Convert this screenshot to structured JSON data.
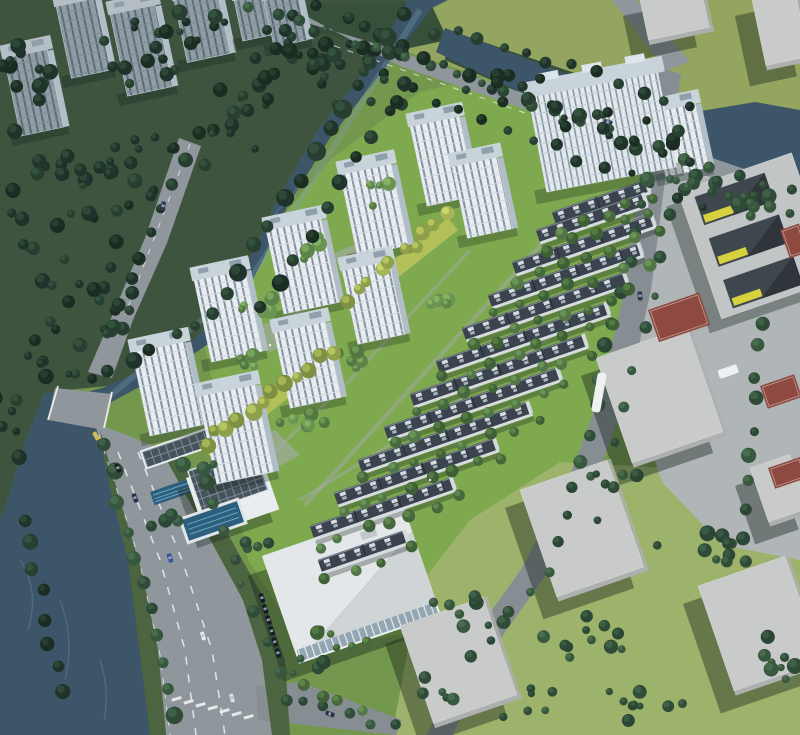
{
  "meta": {
    "title": "Aerial rendering of a riverside residential development with high-rise towers, townhouse rows, canal, arterial road and surrounding context blocks"
  },
  "colors": {
    "siteGreen": "#7ea94f",
    "lawnNE": "#93a55e",
    "lawnSE": "#9db26b",
    "plaza": "#b0b5b8",
    "darkZone": "#3e543f",
    "darkBand": "#36503a",
    "verge": "#4c6440",
    "waterDark": "#3c5568",
    "waterMid": "#46617595",
    "waterLight": "#7da0b2",
    "road": "#8f979c",
    "roadMinor": "#868e93",
    "laneMark": "#eef1f2",
    "pathGray": "#a3aaa6",
    "towerFace": "#e9edef",
    "towerWin": "#64788a",
    "towerRoof": "#c8d3da",
    "towerSide": "#b2bec7",
    "ctxFace": "#909da5",
    "ctxWin": "#53636d",
    "ctxRoof": "#b4bec4",
    "slabFace": "#e3e8eb",
    "slabWin": "#6d8294",
    "rowRoof": "#3a434e",
    "rowPanel": "#dde4e9",
    "rowFace": "#d6dbdf",
    "rowEnd": "#d3dade",
    "boxTop": "#c9cbca",
    "boxSide": "#aeb0af",
    "schoolTop": "#c2c5c6",
    "schoolCourt": "#3f474e",
    "schoolYellow": "#d6d23f",
    "courtRed": "#8e4a40",
    "commWall": "#eceff0",
    "commRoofA": "#e4e7e9",
    "commRoofB": "#cfd4d6",
    "commGlass": "#93a6b1",
    "poolDark": "#2c5e7d",
    "poolLight": "#7fb6cd",
    "yellowBand": "#b9c25a",
    "shadow": "#13211a",
    "carDark": "#151c27",
    "busWhite": "#eef1f2"
  },
  "scene": {
    "towers": [
      [
        132,
        352,
        54,
        86
      ],
      [
        198,
        396,
        58,
        90
      ],
      [
        194,
        280,
        52,
        84
      ],
      [
        266,
        230,
        56,
        86
      ],
      [
        274,
        332,
        52,
        78
      ],
      [
        340,
        174,
        52,
        84
      ],
      [
        342,
        270,
        48,
        76
      ],
      [
        410,
        126,
        50,
        82
      ],
      [
        452,
        166,
        46,
        74
      ],
      [
        652,
        112,
        44,
        66
      ]
    ],
    "slab": {
      "x": 528,
      "y": 96,
      "w": 132,
      "h": 98
    },
    "context_towers": [
      [
        4,
        58,
        44,
        80
      ],
      [
        56,
        6,
        40,
        74
      ],
      [
        110,
        14,
        46,
        84
      ],
      [
        174,
        0,
        44,
        64
      ],
      [
        234,
        0,
        30,
        42
      ],
      [
        264,
        0,
        34,
        48
      ]
    ],
    "townhouse_rows": [
      [
        552,
        212,
        100
      ],
      [
        536,
        230,
        114
      ],
      [
        512,
        262,
        148
      ],
      [
        488,
        295,
        160
      ],
      [
        462,
        328,
        172
      ],
      [
        436,
        361,
        180
      ],
      [
        410,
        394,
        184
      ],
      [
        384,
        427,
        184
      ],
      [
        358,
        460,
        180
      ],
      [
        334,
        493,
        170
      ],
      [
        310,
        526,
        150
      ],
      [
        318,
        560,
        92
      ]
    ],
    "context_boxes": [
      [
        596,
        358,
        100,
        116,
        -19
      ],
      [
        520,
        490,
        96,
        118,
        -19
      ],
      [
        400,
        626,
        92,
        108,
        -19
      ],
      [
        698,
        586,
        96,
        116,
        -19
      ],
      [
        750,
        468,
        46,
        62,
        -19
      ],
      [
        640,
        0,
        66,
        46,
        -12
      ],
      [
        752,
        0,
        48,
        72,
        -12
      ]
    ],
    "red_courts": [
      [
        648,
        310,
        54,
        34
      ],
      [
        760,
        386,
        36,
        24
      ],
      [
        768,
        468,
        34,
        22
      ],
      [
        780,
        230,
        20,
        30
      ]
    ],
    "tree_clusters": [
      [
        60,
        210,
        75,
        55,
        24,
        "dark"
      ],
      [
        150,
        178,
        60,
        42,
        16,
        "dark"
      ],
      [
        238,
        118,
        52,
        40,
        14,
        "dark"
      ],
      [
        88,
        298,
        62,
        42,
        16,
        "dark"
      ],
      [
        24,
        95,
        40,
        52,
        12,
        "dark"
      ],
      [
        130,
        52,
        55,
        32,
        12,
        "dark"
      ],
      [
        210,
        28,
        48,
        22,
        9,
        "dark"
      ],
      [
        282,
        66,
        45,
        28,
        10,
        "dark"
      ],
      [
        55,
        352,
        42,
        26,
        9,
        "dark"
      ],
      [
        6,
        428,
        26,
        36,
        7,
        "dark"
      ],
      [
        362,
        74,
        72,
        42,
        20,
        "dark"
      ],
      [
        325,
        26,
        45,
        22,
        9,
        "dark"
      ],
      [
        688,
        182,
        34,
        15,
        7,
        "mid"
      ],
      [
        748,
        204,
        28,
        13,
        6,
        "mid"
      ],
      [
        505,
        88,
        42,
        18,
        8,
        "dark"
      ],
      [
        585,
        112,
        42,
        18,
        8,
        "dark"
      ],
      [
        645,
        135,
        36,
        16,
        7,
        "dark"
      ],
      [
        575,
        645,
        55,
        30,
        11,
        "mid"
      ],
      [
        690,
        552,
        45,
        26,
        9,
        "mid"
      ],
      [
        655,
        700,
        52,
        26,
        9,
        "mid"
      ],
      [
        768,
        648,
        34,
        38,
        8,
        "mid"
      ],
      [
        525,
        702,
        34,
        20,
        6,
        "mid"
      ],
      [
        468,
        612,
        40,
        24,
        8,
        "mid"
      ],
      [
        608,
        478,
        34,
        18,
        6,
        "mid"
      ],
      [
        432,
        692,
        28,
        18,
        5,
        "mid"
      ],
      [
        252,
        300,
        26,
        18,
        6,
        "lightB"
      ],
      [
        318,
        248,
        24,
        16,
        5,
        "lightB"
      ],
      [
        385,
        195,
        24,
        16,
        5,
        "lightB"
      ],
      [
        300,
        420,
        26,
        16,
        6,
        "lightB"
      ],
      [
        360,
        355,
        24,
        14,
        5,
        "lightB"
      ],
      [
        430,
        300,
        22,
        14,
        5,
        "lightB"
      ],
      [
        245,
        368,
        20,
        14,
        4,
        "lightB"
      ],
      [
        200,
        472,
        22,
        14,
        5,
        "mid"
      ],
      [
        165,
        520,
        20,
        12,
        4,
        "mid"
      ],
      [
        252,
        545,
        18,
        12,
        4,
        "mid"
      ],
      [
        338,
        640,
        30,
        16,
        6,
        "bright"
      ],
      [
        300,
        665,
        24,
        14,
        5,
        "mid"
      ]
    ],
    "tree_lines": [
      [
        250,
        6,
        788,
        192,
        22,
        "mid",
        5
      ],
      [
        268,
        34,
        700,
        205,
        19,
        "dark",
        5
      ],
      [
        402,
        12,
        225,
        295,
        13,
        "dark",
        8
      ],
      [
        215,
        310,
        90,
        382,
        7,
        "dark",
        7
      ],
      [
        436,
        34,
        262,
        310,
        12,
        "dark",
        7
      ],
      [
        455,
        30,
        690,
        105,
        11,
        "dark",
        6
      ],
      [
        445,
        62,
        688,
        162,
        10,
        "dark",
        6
      ],
      [
        106,
        448,
        178,
        718,
        11,
        "mid",
        7
      ],
      [
        210,
        500,
        288,
        700,
        8,
        "mid",
        5
      ],
      [
        25,
        520,
        60,
        690,
        8,
        "dark",
        8
      ],
      [
        650,
        180,
        560,
        545,
        14,
        "mid",
        6
      ],
      [
        548,
        570,
        470,
        660,
        5,
        "mid",
        6
      ],
      [
        680,
        180,
        600,
        520,
        10,
        "mid",
        5
      ],
      [
        760,
        320,
        742,
        565,
        10,
        "mid",
        6
      ],
      [
        690,
        190,
        790,
        215,
        6,
        "mid",
        5
      ],
      [
        300,
        700,
        395,
        728,
        5,
        "mid",
        5
      ],
      [
        205,
        442,
        330,
        350,
        12,
        "yel",
        7
      ],
      [
        345,
        298,
        448,
        216,
        10,
        "yel",
        6
      ],
      [
        185,
        160,
        110,
        330,
        8,
        "dark",
        6
      ],
      [
        300,
        688,
        360,
        712,
        4,
        "bright",
        6
      ]
    ],
    "cars": [
      [
        135,
        498,
        70,
        "#23304f"
      ],
      [
        170,
        558,
        72,
        "#2f57a0"
      ],
      [
        203,
        636,
        74,
        "#e9ecee"
      ],
      [
        232,
        698,
        76,
        "#dde0e2"
      ],
      [
        118,
        468,
        68,
        "#171e29"
      ],
      [
        96,
        436,
        62,
        "#d6bf3b"
      ],
      [
        163,
        206,
        104,
        "#2b3a55"
      ],
      [
        608,
        122,
        17,
        "#32415c"
      ],
      [
        640,
        296,
        86,
        "#2e3a4e"
      ],
      [
        330,
        714,
        20,
        "#263249"
      ]
    ],
    "parked_cars": [
      {
        "x": 262,
        "y": 598,
        "sx": 3.2,
        "sy": 11,
        "n": 6,
        "a": 72
      }
    ],
    "bus": {
      "x": 598,
      "y": 372,
      "a": 10
    },
    "crosswalk": {
      "x1": 181,
      "y1": 696,
      "x2": 253,
      "y2": 714,
      "n": 7,
      "a": 74
    },
    "people": [
      [
        255,
        330
      ],
      [
        270,
        345
      ],
      [
        320,
        300
      ],
      [
        230,
        440
      ],
      [
        430,
        480
      ],
      [
        470,
        330
      ]
    ],
    "counts": {
      "highrise_towers": 10,
      "wide_slab_building": 1,
      "townhouse_rows": 12,
      "context_towers": 6,
      "context_massing_boxes": 7,
      "red_sport_courts": 4,
      "swimming_pools": 2,
      "bridges": 1
    }
  }
}
